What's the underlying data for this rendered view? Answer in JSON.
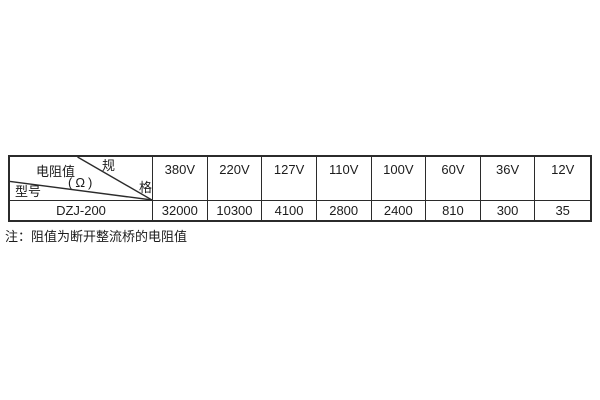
{
  "page": {
    "background": "#ffffff",
    "text_color": "#1c1c1c",
    "border_color": "#2b2b2b"
  },
  "table": {
    "corner": {
      "spec_char_top": "规",
      "spec_char_bottom": "格",
      "value_label": "电阻值",
      "value_unit": "(Ω)",
      "model_label": "型号"
    },
    "columns": [
      "380V",
      "220V",
      "127V",
      "110V",
      "100V",
      "60V",
      "36V",
      "12V"
    ],
    "rows": [
      {
        "model": "DZJ-200",
        "values": [
          "32000",
          "10300",
          "4100",
          "2800",
          "2400",
          "810",
          "300",
          "35"
        ]
      }
    ]
  },
  "note": {
    "text": "注：阻值为断开整流桥的电阻值"
  }
}
